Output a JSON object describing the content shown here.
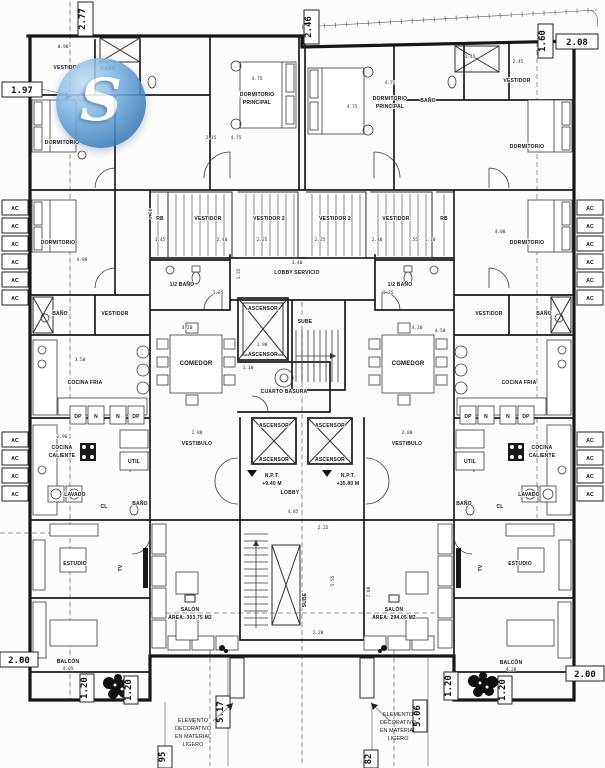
{
  "document": {
    "kind": "architectural floor plan",
    "language": "Spanish"
  },
  "watermark": {
    "letter": "S",
    "accent_color": "#4f93cf"
  },
  "labels": {
    "vestidor": "VESTIDOR",
    "vestidor_2": "VESTIDOR 2",
    "bano": "BAÑO",
    "medio_bano": "1/2 BAÑO",
    "dormitorio": "DORMITORIO",
    "dormitorio_principal_1": "DORMITORIO",
    "dormitorio_principal_2": "PRINCIPAL",
    "rb": "RB",
    "lobby_servicio": "LOBBY SERVICIO",
    "ascensor": "ASCENSOR",
    "sube": "SUBE",
    "cuarto_basura": "CUARTO BASURA",
    "comedor": "COMEDOR",
    "cocina_fria": "COCINA FRIA",
    "cocina_1": "COCINA",
    "cocina_2": "CALIENTE",
    "util": "UTIL",
    "lavado": "LAVADO",
    "cl": "CL",
    "estudio": "ESTUDIO",
    "vestibulo": "VESTIBULO",
    "lobby": "LOBBY",
    "npt": "N.P.T.",
    "salon": "SALÓN",
    "balcon": "BALCÓN",
    "ac": "AC",
    "dp": "DP",
    "n": "N",
    "tv": "TV"
  },
  "levels": {
    "left": "+9.40 M",
    "right": "+35.80 M"
  },
  "areas": {
    "salon_left": "ÁREA: 303.75 M2",
    "salon_right": "ÁREA: 294.05 M2"
  },
  "annotations": {
    "decorative_1": "ELEMENTO",
    "decorative_2": "DECORATIVO",
    "decorative_3": "EN MATERIAL",
    "decorative_4": "LIGERO"
  },
  "dimensions": {
    "boxed": {
      "b197": "1.97",
      "b277": "2.77",
      "b246": "2.46",
      "b160": "1.60",
      "b208": "2.08",
      "b200": "2.00",
      "b120": "1.20",
      "b517": "5.17",
      "b506": "5.06",
      "b95": "95",
      "b82": "82"
    },
    "inline": {
      "v475": "4.75",
      "v215": "2.15",
      "v145": "1.45",
      "v240": "2.40",
      "v225": "2.25",
      "v340": "3.40",
      "v135": "1.35",
      "v125": "1.25",
      "v420": "4.20",
      "v190": "1.90",
      "v110": "1.10",
      "v485": "4.85",
      "v555": "5.55",
      "v220": "2.20",
      "v280": "2.80",
      "v290": "2.90",
      "v480": "4.80",
      "v400": "4.00",
      "v450": "4.50",
      "v350": "3.50",
      "v708": "7.08",
      "v405": "4.05",
      "v428": "4.28",
      "v090": "0.90",
      "v245": "2.45",
      "v055": ".55"
    }
  }
}
